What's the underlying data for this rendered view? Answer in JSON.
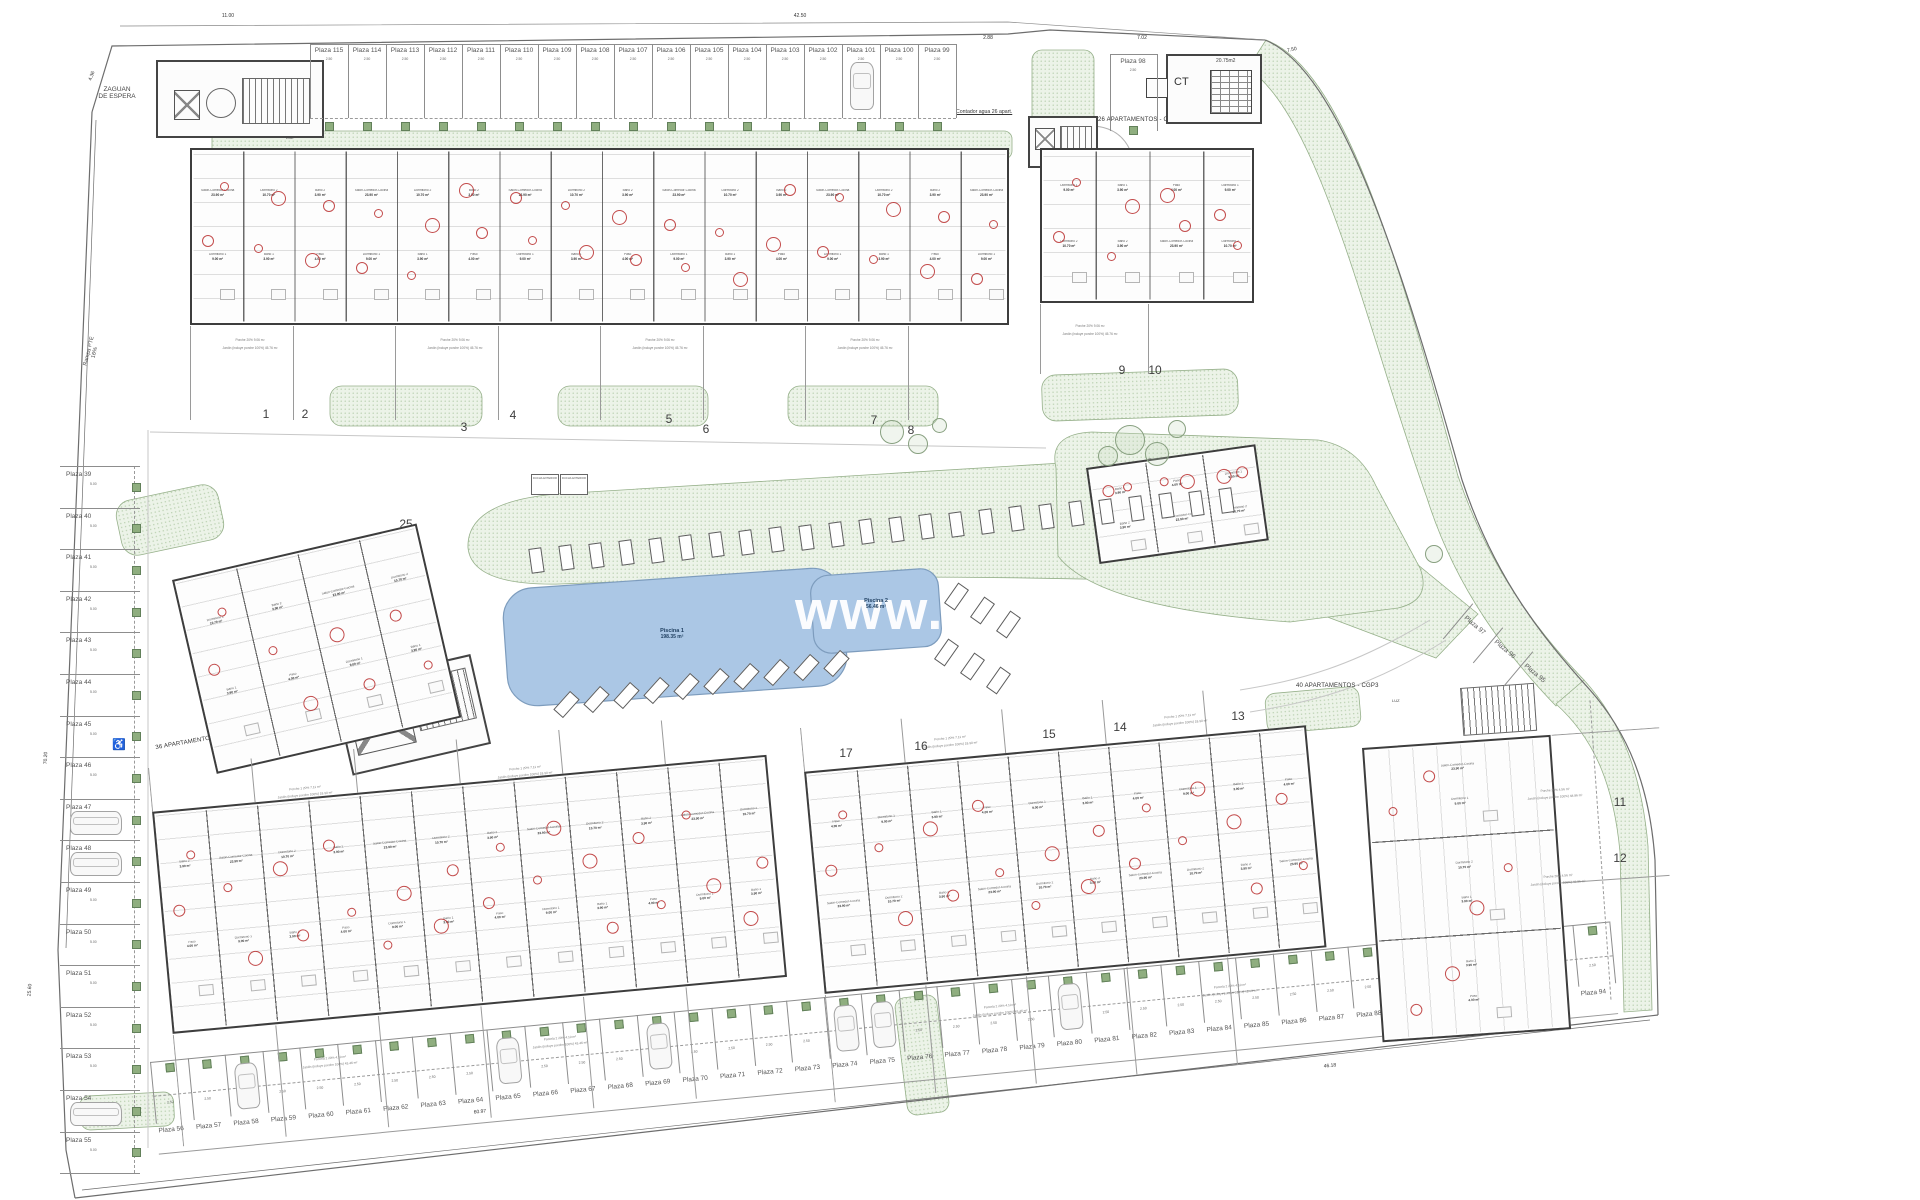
{
  "watermark": "www.nov",
  "labels": {
    "zaguan_line1": "ZAGUAN",
    "zaguan_line2": "DE ESPERA",
    "rampa": "Rampa PTE 16%",
    "ct": "CT",
    "ct_area": "20.75m2",
    "apt_cgp1": "26 APARTAMENTOS - CGP1",
    "apt_cgp2": "26 APARTAMENTOS - CGP2",
    "apt_cgp3": "40 APARTAMENTOS - CGP3",
    "apt_cgp4": "36 APARTAMENTOS - CGP4",
    "contador_26_a": "Contador agua 26 apart.",
    "contador_26_b": "Contador agua 26 apart.",
    "contador_comunidad": "Contador agua y luz comunidad",
    "contador_76": "Contador agua 76 apart.",
    "luz": "LUZ",
    "ducha": "DUCHA EXTERIOR"
  },
  "pools": [
    {
      "name": "Piscina 1",
      "area": "198.35 m²"
    },
    {
      "name": "Piscina 2",
      "area": "56.46 m²"
    }
  ],
  "parking": {
    "prefix": "Plaza",
    "stall_width": "2.50",
    "stall_depth": "5.00",
    "top_row": [
      115,
      114,
      113,
      112,
      111,
      110,
      109,
      108,
      107,
      106,
      105,
      104,
      103,
      102,
      101,
      100,
      99
    ],
    "top_single": 98,
    "left_col": [
      39,
      40,
      41,
      42,
      43,
      44,
      45,
      46,
      47,
      48,
      49,
      50,
      51,
      52,
      53,
      54,
      55
    ],
    "bottom_row": [
      56,
      57,
      58,
      59,
      60,
      61,
      62,
      63,
      64,
      65,
      66,
      67,
      68,
      69,
      70,
      71,
      72,
      73,
      74,
      75,
      76,
      77,
      78,
      79,
      80,
      81,
      82,
      83,
      84,
      85,
      86,
      87,
      88,
      89,
      90,
      91,
      92,
      93,
      94
    ],
    "right_diag": [
      97,
      96,
      95
    ]
  },
  "plots": [
    1,
    2,
    3,
    4,
    5,
    6,
    7,
    8,
    9,
    10,
    11,
    12,
    13,
    14,
    15,
    16,
    17,
    18,
    19,
    20,
    21,
    22,
    23,
    24,
    25
  ],
  "rooms": [
    {
      "name": "Salón-Comedor-Cocina",
      "area": "23.90 m²"
    },
    {
      "name": "Dormitorio 1",
      "area": "9.00 m²"
    },
    {
      "name": "Dormitorio 2",
      "area": "10.70 m²"
    },
    {
      "name": "Baño 1",
      "area": "3.90 m²"
    },
    {
      "name": "Baño 2",
      "area": "3.90 m²"
    },
    {
      "name": "Paso",
      "area": "4.00 m²"
    }
  ],
  "garden_labels": [
    "Porche 20% 9.06 m²",
    "Jardín (incluye porche 100%) 45.76 m²",
    "Porche 1 20% 7.11 m²",
    "Jardín (incluye porche 100%) 18.90 m²",
    "Parcela 2 20% 4.10 m²",
    "Jardín (incluye porche 100%) 43.46 m²",
    "Porche 20% 4.56 m²",
    "Jardín (incluye porche 100%) 48.86 m²"
  ],
  "dimensions": {
    "top": [
      "11.00",
      "42.50",
      "2.88",
      "7.02",
      "7.50"
    ],
    "left": [
      "4.36",
      "70.20",
      "25.60"
    ],
    "bottom": [
      "60.97",
      "46.18"
    ]
  }
}
